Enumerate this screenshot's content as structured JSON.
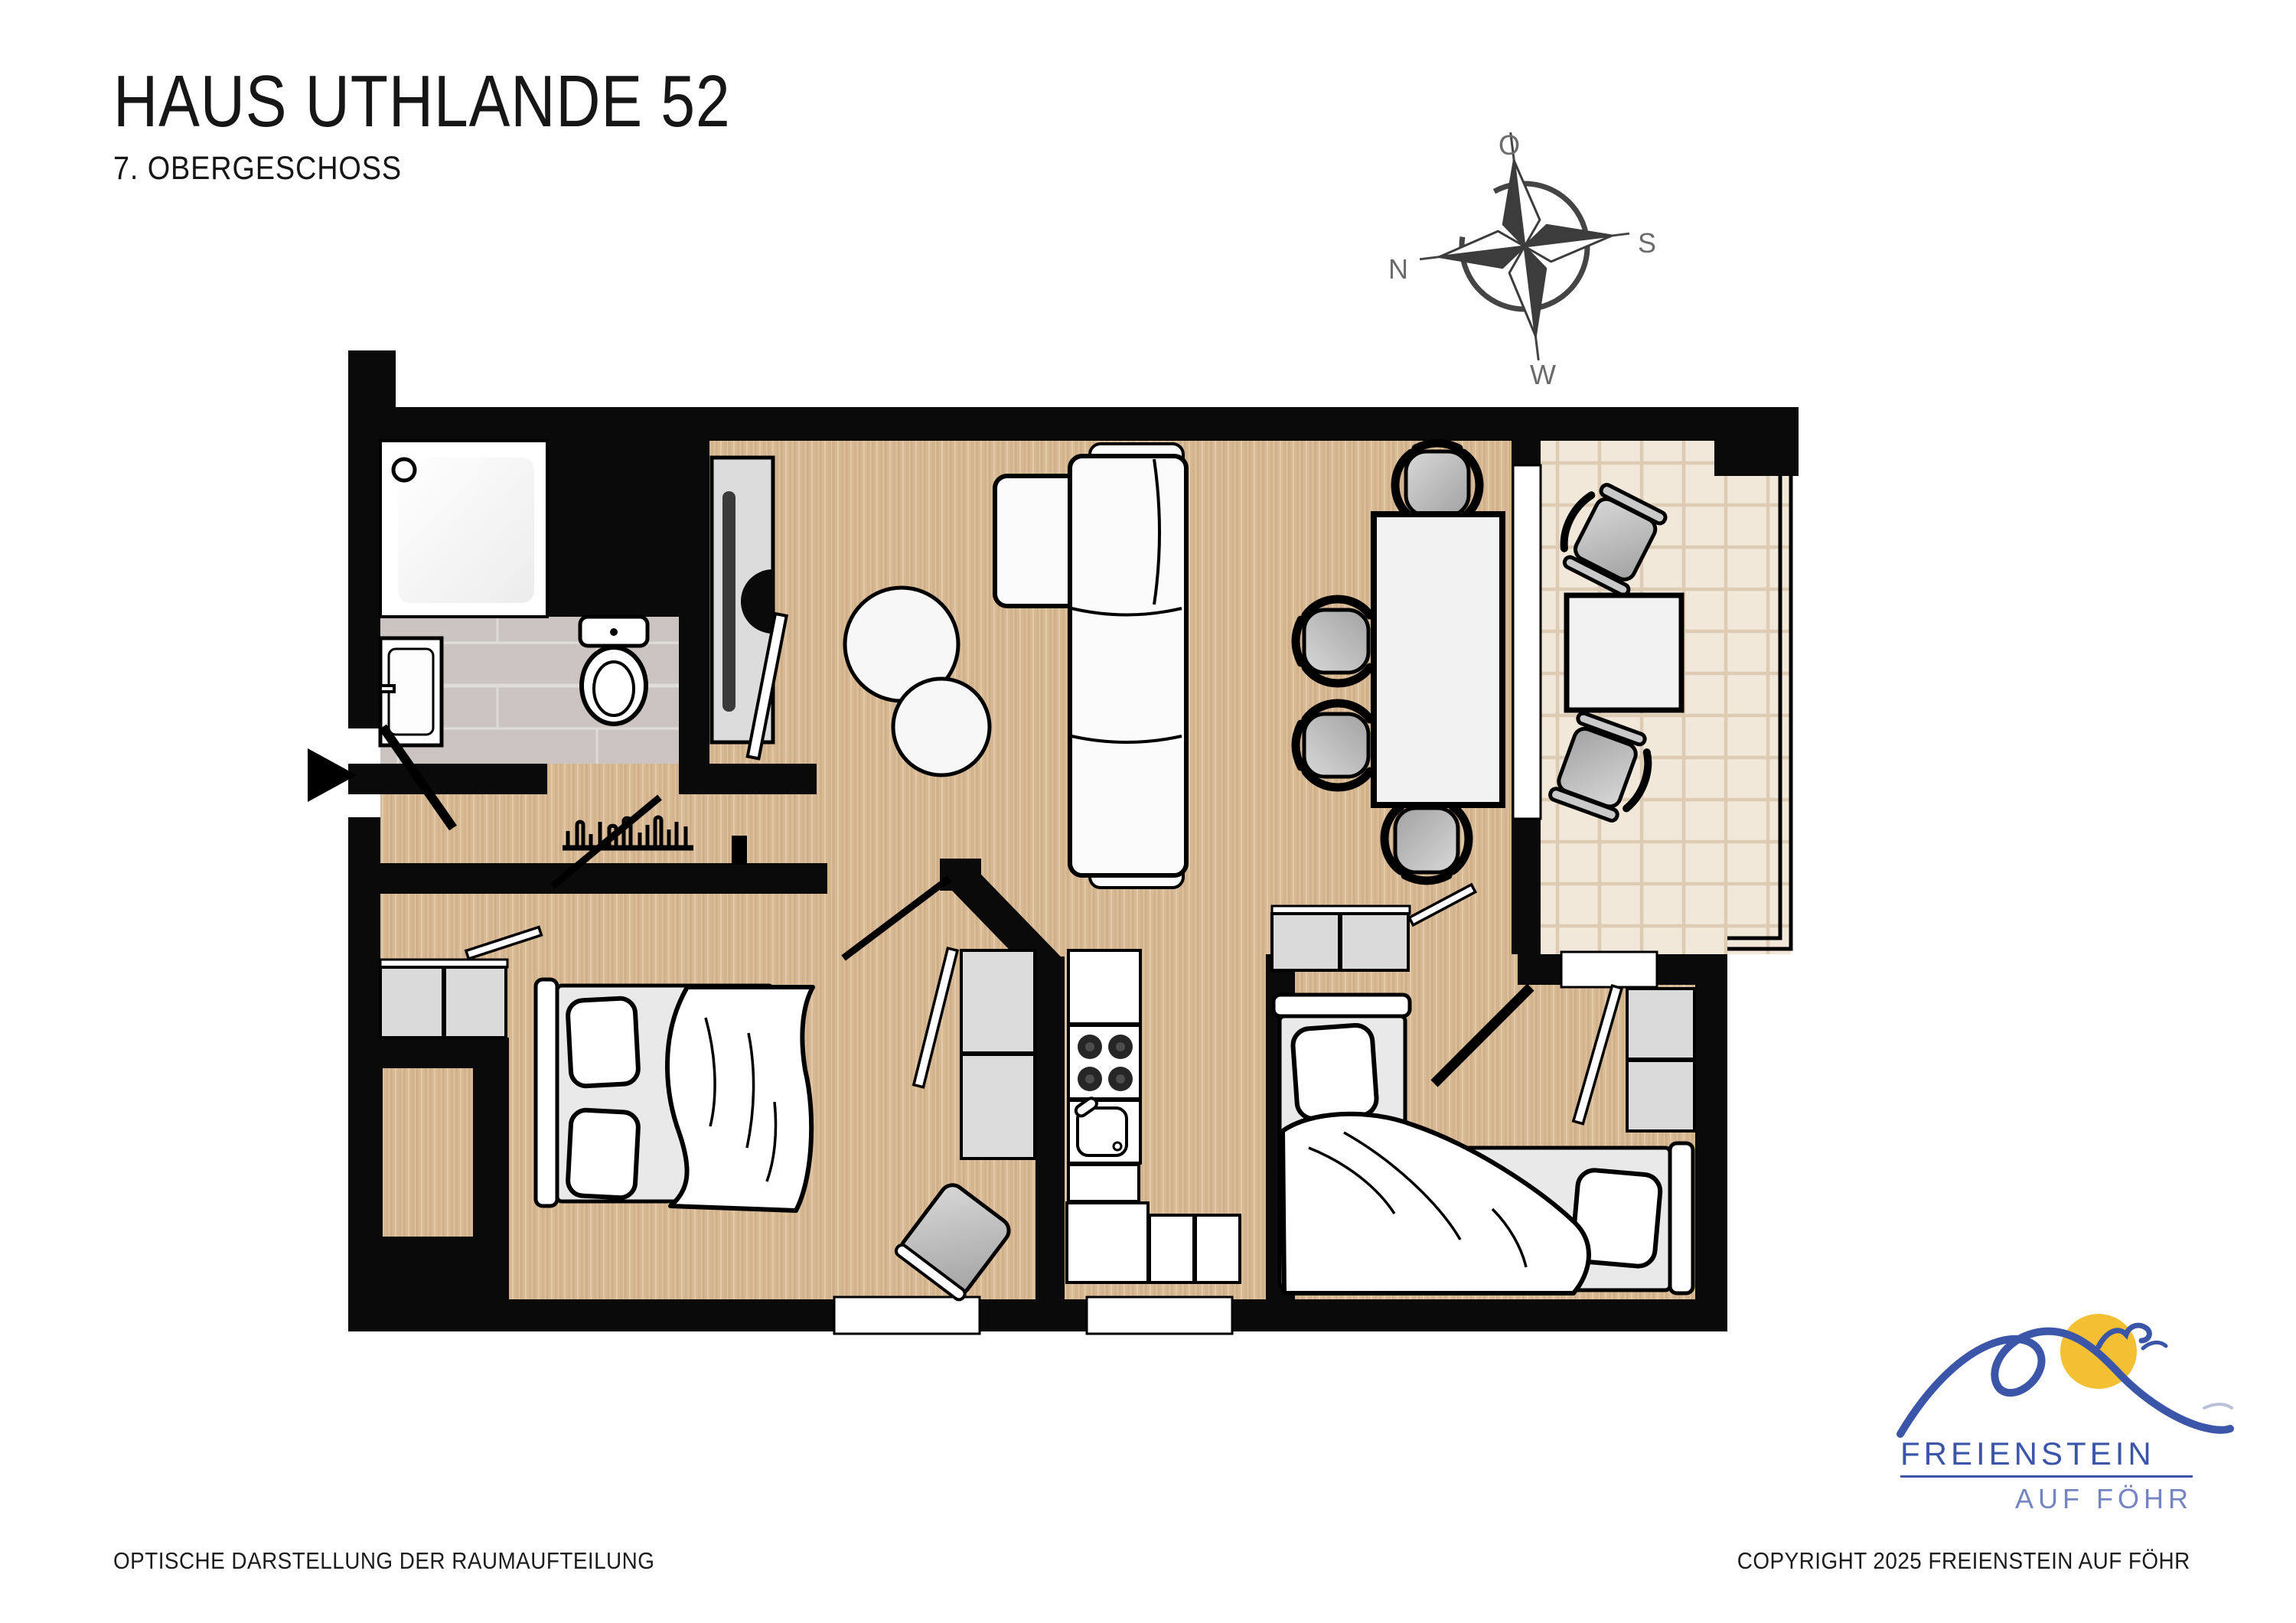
{
  "header": {
    "title": "HAUS UTHLANDE 52",
    "subtitle": "7. OBERGESCHOSS"
  },
  "compass": {
    "icon": "compass-rose-sketch-icon",
    "top": "O",
    "right": "S",
    "bottom": "W",
    "left": "N"
  },
  "floorplan": {
    "kind": "apartment-floor-plan-top-view",
    "rooms": [
      {
        "name": "bathroom",
        "furniture": [
          "shower",
          "washbasin",
          "toilet"
        ]
      },
      {
        "name": "hallway",
        "furniture": [
          "entrance-door",
          "tall-wardrobe-cabinet",
          "coat-rack"
        ]
      },
      {
        "name": "living-dining-room",
        "furniture": [
          "corner-sofa",
          "round-coffee-table",
          "round-side-table",
          "dining-table",
          "dining-chair",
          "dining-chair",
          "dining-chair",
          "dining-chair"
        ]
      },
      {
        "name": "bedroom-1",
        "furniture": [
          "double-bed",
          "sideboard",
          "shelf-cabinet",
          "stool-cushion"
        ]
      },
      {
        "name": "kitchen",
        "furniture": [
          "upper-counter",
          "stove-4-burners",
          "sink-unit",
          "lower-counter-L"
        ]
      },
      {
        "name": "bedroom-2",
        "furniture": [
          "single-bed-vertical",
          "single-bed-horizontal",
          "sideboard",
          "wardrobe-cabinet"
        ]
      },
      {
        "name": "balcony",
        "furniture": [
          "balcony-table",
          "balcony-chair",
          "balcony-chair"
        ]
      }
    ],
    "openings": [
      "entrance-arrow",
      "entrance-door-swing",
      "bathroom-door-swing",
      "bedroom-1-door-swing",
      "bedroom-2-door-swing",
      "sliding-balcony-door",
      "window-bottom-1",
      "window-bottom-2",
      "window-bedroom-2"
    ]
  },
  "logo": {
    "icon": "freienstein-wave-sun-gull-logo",
    "name": "FREIENSTEIN",
    "tagline": "AUF FÖHR"
  },
  "footer": {
    "left": "OPTISCHE DARSTELLUNG DER RAUMAUFTEILUNG",
    "right": "COPYRIGHT 2025 FREIENSTEIN AUF FÖHR"
  },
  "colors": {
    "wall": "#0a0a0a",
    "wood_floor": "#d7b995",
    "bathroom_tile": "#ccc4c0",
    "balcony_tile": "#f2e8da",
    "furniture_gray": "#c9c9c9",
    "mattress_gray": "#e9e9e9",
    "logo_blue": "#3b55a8",
    "logo_light_blue": "#7585c2",
    "sun_yellow": "#f2c032"
  }
}
